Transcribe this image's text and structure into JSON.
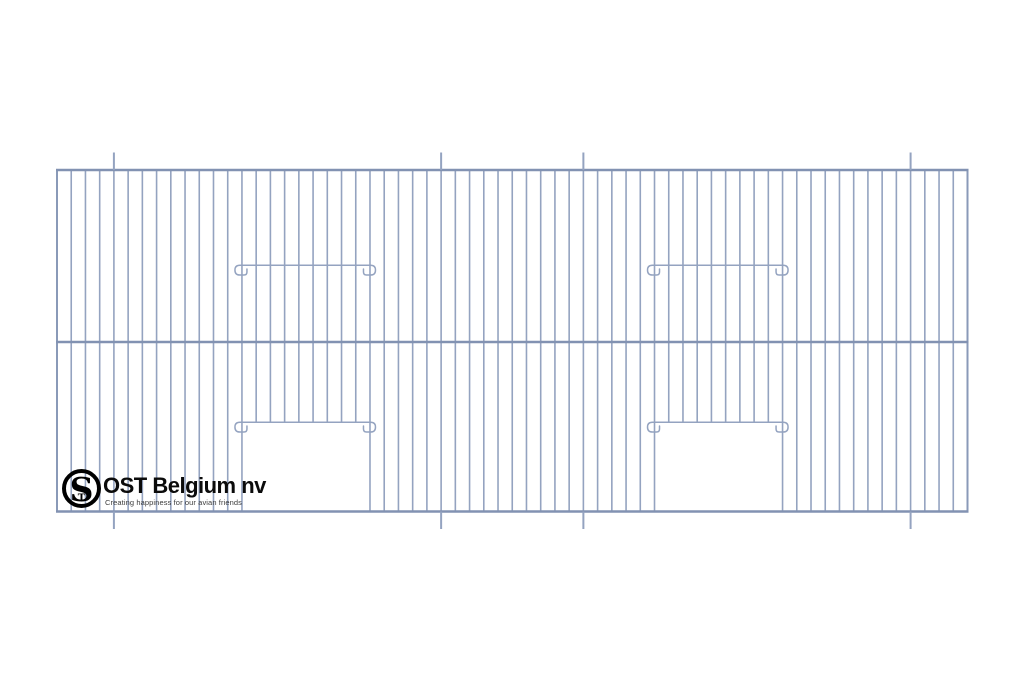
{
  "page": {
    "background": "#ffffff",
    "width": 1024,
    "height": 683
  },
  "drawing": {
    "wire_color": "#94a3c0",
    "edge_wire_color": "#8a9ab8",
    "rail_color": "#8292b2",
    "wire_width": 1.6,
    "edge_wire_width": 2,
    "rail_width": 2.4,
    "post_width": 2,
    "panel": {
      "x_left": 57,
      "x_right": 967.5,
      "y_top": 170,
      "y_middle": 342,
      "y_bottom": 511.5
    },
    "wires": {
      "count": 65
    },
    "posts": {
      "wire_indices": [
        4,
        27,
        37,
        60
      ],
      "extension": 17.5
    },
    "doors": [
      {
        "left_wire": 13,
        "right_wire": 22
      },
      {
        "left_wire": 42,
        "right_wire": 51
      }
    ],
    "door_wire_end": 423,
    "feeder_bar_y": 264.5,
    "door_bar_y": 421.5,
    "bar_height": 10.5,
    "bar_overhang_left": 8,
    "bar_overhang_right": 6.5
  },
  "logo": {
    "monogram_s": "S",
    "monogram_t": "T",
    "title": "OST Belgium nv",
    "tagline": "Creating happiness for our avian friends",
    "ring_color": "#000000",
    "title_color": "#0b0b0b",
    "tagline_color": "#3c3c3c"
  }
}
